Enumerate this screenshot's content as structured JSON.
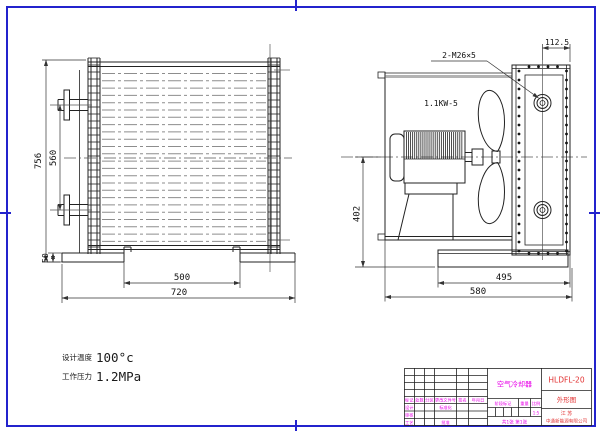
{
  "colors": {
    "frame_blue": "#2323cd",
    "line": "#222222",
    "magenta": "#e800e8",
    "red": "#e23333",
    "tube_gray": "#8d8d8d"
  },
  "notes": {
    "temp_label": "设计温度",
    "temp_value": "100°c",
    "press_label": "工作压力",
    "press_value": "1.2MPa"
  },
  "front_view": {
    "dims": {
      "overall_height": "756",
      "port_spacing": "560",
      "base_height": "50",
      "foot_spacing": "500",
      "overall_width": "720"
    }
  },
  "side_view": {
    "dims": {
      "port_offset": "112.5",
      "center_to_base": "402",
      "base_width": "495",
      "overall_width": "580"
    },
    "labels": {
      "thread_ports": "2-M26×5",
      "motor_power": "1.1KW-5"
    }
  },
  "title_block": {
    "product_name": "空气冷却器",
    "drawing_no": "HLDFL-20",
    "view_title": "外形图",
    "region": "江 苏",
    "company": "中通新能源有限公司",
    "rev_headers": [
      "标记",
      "处数",
      "分区",
      "更改文件号",
      "签名",
      "年月日"
    ],
    "roles": {
      "design": "设计",
      "check": "审核",
      "process": "工艺",
      "standardization": "标准化",
      "approve": "批准"
    },
    "fields": {
      "stage": "阶段标记",
      "weight": "重量",
      "scale": "比例",
      "scale_value": "1:5",
      "sheet_note": "共1张 第1张"
    }
  }
}
